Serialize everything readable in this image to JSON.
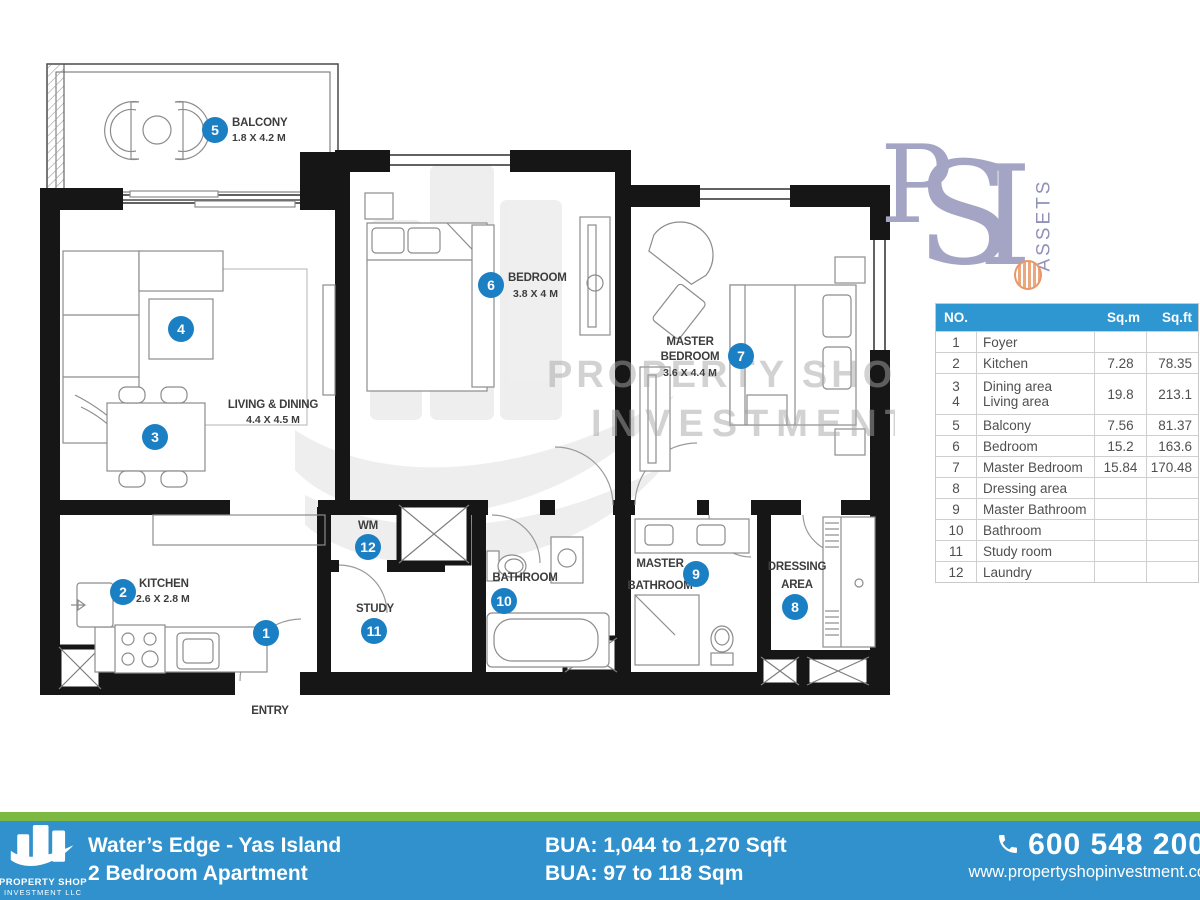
{
  "watermark": {
    "line1": "PROPERTY SHOP",
    "line2": "INVESTMENT L"
  },
  "psi_logo": {
    "p": "P",
    "s": "S",
    "i": "I",
    "assets": "ASSETS"
  },
  "floorplan": {
    "entry_label": "ENTRY",
    "entry_no": "1",
    "balcony": {
      "no": "5",
      "name": "BALCONY",
      "dims": "1.8 X 4.2 M"
    },
    "living": {
      "no3": "3",
      "no4": "4",
      "name": "LIVING & DINING",
      "dims": "4.4 X 4.5 M"
    },
    "kitchen": {
      "no": "2",
      "name": "KITCHEN",
      "dims": "2.6 X 2.8 M"
    },
    "bedroom": {
      "no": "6",
      "name": "BEDROOM",
      "dims": "3.8 X 4 M"
    },
    "master_bedroom": {
      "no": "7",
      "name1": "MASTER",
      "name2": "BEDROOM",
      "dims": "3.6 X 4.4 M"
    },
    "wm": {
      "no": "12",
      "name": "WM"
    },
    "study": {
      "no": "11",
      "name": "STUDY"
    },
    "bathroom": {
      "no": "10",
      "name": "BATHROOM"
    },
    "master_bathroom": {
      "no": "9",
      "name1": "MASTER",
      "name2": "BATHROOM"
    },
    "dressing": {
      "no": "8",
      "name1": "DRESSING",
      "name2": "AREA"
    }
  },
  "area_table": {
    "headers": {
      "no": "NO.",
      "name": "",
      "sqm": "Sq.m",
      "sqft": "Sq.ft"
    },
    "rows": [
      {
        "no": "1",
        "name": "Foyer",
        "sqm": "",
        "sqft": ""
      },
      {
        "no": "2",
        "name": "Kitchen",
        "sqm": "7.28",
        "sqft": "78.35"
      },
      {
        "no": "3",
        "name": "Dining area",
        "no2": "4",
        "name2": "Living area",
        "sqm": "19.8",
        "sqft": "213.1"
      },
      {
        "no": "5",
        "name": "Balcony",
        "sqm": "7.56",
        "sqft": "81.37"
      },
      {
        "no": "6",
        "name": "Bedroom",
        "sqm": "15.2",
        "sqft": "163.6"
      },
      {
        "no": "7",
        "name": "Master Bedroom",
        "sqm": "15.84",
        "sqft": "170.48"
      },
      {
        "no": "8",
        "name": "Dressing area",
        "sqm": "",
        "sqft": ""
      },
      {
        "no": "9",
        "name": "Master Bathroom",
        "sqm": "",
        "sqft": ""
      },
      {
        "no": "10",
        "name": "Bathroom",
        "sqm": "",
        "sqft": ""
      },
      {
        "no": "11",
        "name": "Study room",
        "sqm": "",
        "sqft": ""
      },
      {
        "no": "12",
        "name": "Laundry",
        "sqm": "",
        "sqft": ""
      }
    ]
  },
  "footer": {
    "logo_line1": "PROPERTY SHOP",
    "logo_line2": "INVESTMENT LLC",
    "project": "Water’s Edge - Yas Island",
    "unit_type": "2 Bedroom Apartment",
    "bua_sqft": "BUA: 1,044 to 1,270 Sqft",
    "bua_sqm": "BUA: 97 to 118 Sqm",
    "phone": "600 548 200",
    "website": "www.propertyshopinvestment.co"
  },
  "colors": {
    "marker_blue": "#1b7fc4",
    "table_header_blue": "#2e96d0",
    "footer_blue": "#3191cc",
    "footer_green": "#7cb943",
    "psi_lavender": "#a4a4c5"
  }
}
